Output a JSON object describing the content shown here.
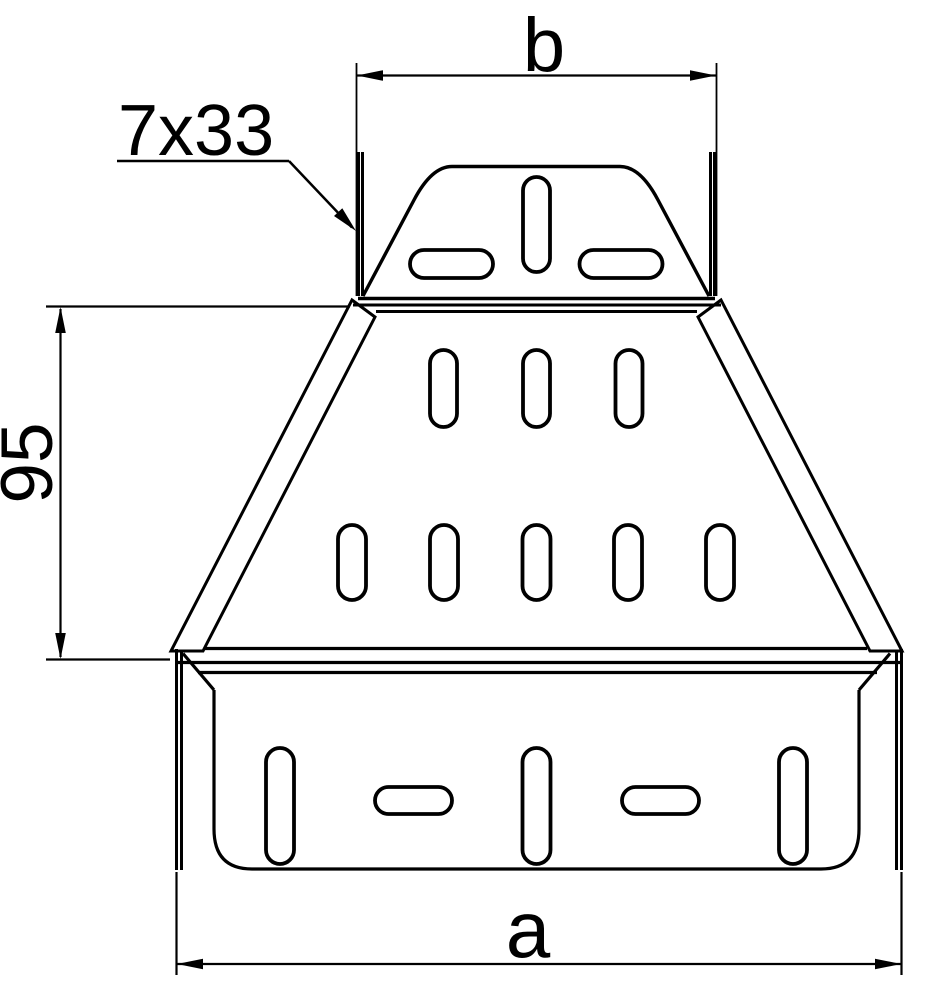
{
  "drawing": {
    "dimension_labels": {
      "top_width": "b",
      "bottom_width": "a",
      "middle_height": "95",
      "slot_callout": "7x33"
    },
    "colors": {
      "line": "#000000",
      "background": "#ffffff"
    }
  }
}
